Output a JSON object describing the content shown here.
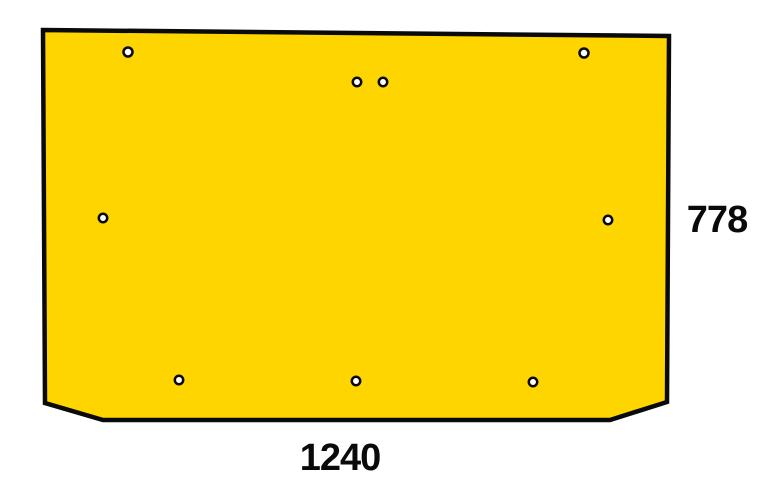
{
  "diagram": {
    "kind": "part-drawing",
    "background_color": "#ffffff",
    "panel": {
      "fill_color": "#FFD500",
      "stroke_color": "#0a0a0a",
      "stroke_width": 4.5,
      "outline_points": [
        [
          43,
          30
        ],
        [
          669,
          36
        ],
        [
          667,
          402
        ],
        [
          610,
          420
        ],
        [
          103,
          420
        ],
        [
          45,
          403
        ]
      ]
    },
    "hole_style": {
      "fill_color": "#ffffff",
      "stroke_color": "#0a0a0a",
      "stroke_width": 2.5
    },
    "holes": [
      {
        "cx": 128,
        "cy": 52,
        "r": 4.5
      },
      {
        "cx": 584,
        "cy": 53,
        "r": 4.5
      },
      {
        "cx": 357,
        "cy": 82,
        "r": 4.2
      },
      {
        "cx": 383,
        "cy": 82,
        "r": 4.2
      },
      {
        "cx": 103,
        "cy": 218,
        "r": 4.2
      },
      {
        "cx": 608,
        "cy": 220,
        "r": 4.2
      },
      {
        "cx": 179,
        "cy": 380,
        "r": 4.2
      },
      {
        "cx": 356,
        "cy": 381,
        "r": 4.2
      },
      {
        "cx": 533,
        "cy": 382,
        "r": 4.2
      }
    ],
    "dimensions": {
      "height_label": "778",
      "width_label": "1240"
    }
  }
}
